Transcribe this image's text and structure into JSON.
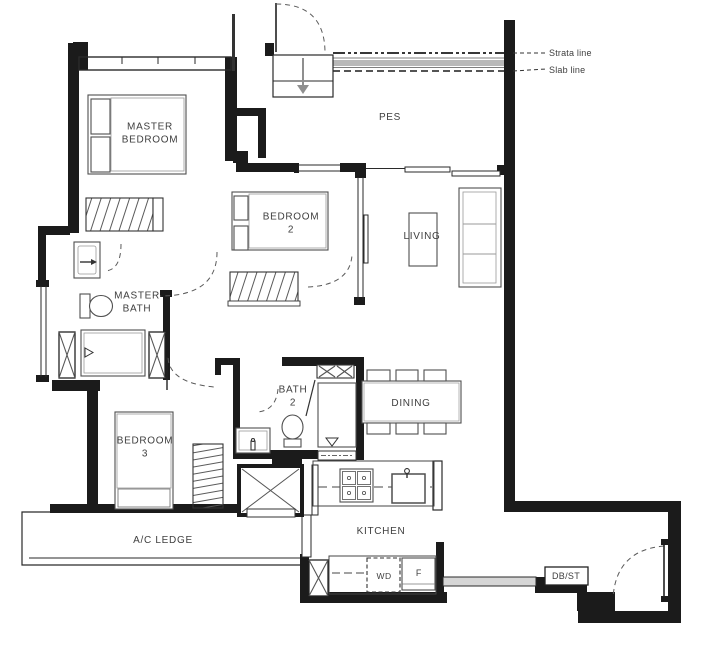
{
  "plan": {
    "type": "apartment-floor-plan",
    "colors": {
      "wall": "#1b1b1b",
      "furniture_line": "#4f4f4f",
      "text": "#3e3e3e",
      "concrete_band": "#b9b9b9",
      "arrow_gray": "#8f8f8f"
    },
    "rooms": {
      "master_bedroom": {
        "line1": "MASTER",
        "line2": "BEDROOM"
      },
      "pes": {
        "label": "PES"
      },
      "bedroom2": {
        "line1": "BEDROOM",
        "line2": "2"
      },
      "living": {
        "label": "LIVING"
      },
      "master_bath": {
        "line1": "MASTER",
        "line2": "BATH"
      },
      "bath2": {
        "line1": "BATH",
        "line2": "2"
      },
      "dining": {
        "label": "DINING"
      },
      "bedroom3": {
        "line1": "BEDROOM",
        "line2": "3"
      },
      "ac_ledge": {
        "label": "A/C LEDGE"
      },
      "kitchen": {
        "label": "KITCHEN"
      }
    },
    "appliances": {
      "washer_dryer": "WD",
      "fridge": "F",
      "db_store": "DB/ST"
    },
    "annotations": {
      "strata_line": "Strata line",
      "slab_line": "Slab line"
    }
  }
}
